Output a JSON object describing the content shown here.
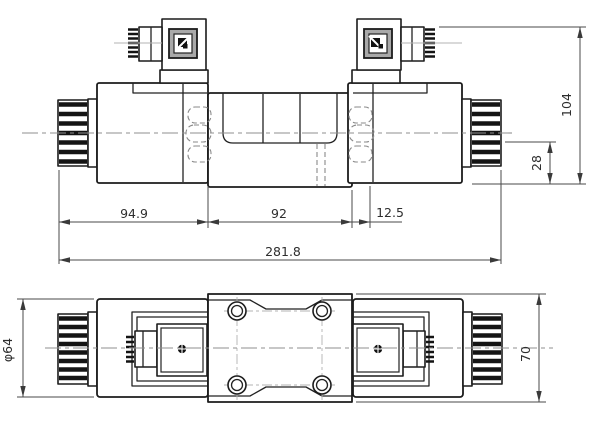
{
  "drawing": {
    "type": "valve-dimension-drawing",
    "front_view": {
      "dim_left_solenoid_length": "94.9",
      "dim_body_length": "92",
      "dim_offset": "12.5",
      "dim_overall_length": "281.8",
      "dim_overall_height": "104",
      "dim_bottom_height": "28"
    },
    "plan_view": {
      "dim_solenoid_diameter": "φ64",
      "dim_body_width": "70"
    },
    "colors": {
      "background": "#ffffff",
      "outline": "#1c1c1c",
      "dimension": "#4a4a4a",
      "centerline": "#8f8f8f",
      "hidden_line": "#8a8a8a",
      "connector_face": "#a9a9a9"
    }
  }
}
